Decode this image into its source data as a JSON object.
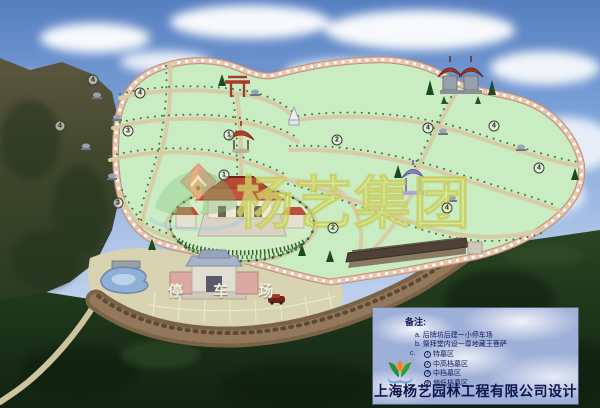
{
  "map": {
    "watermark_text": "杨艺集团",
    "parking_label": "停 车 场"
  },
  "markers": [
    {
      "n": "4",
      "x": 93,
      "y": 80
    },
    {
      "n": "4",
      "x": 140,
      "y": 93
    },
    {
      "n": "4",
      "x": 60,
      "y": 126
    },
    {
      "n": "3",
      "x": 128,
      "y": 131
    },
    {
      "n": "1",
      "x": 229,
      "y": 135
    },
    {
      "n": "2",
      "x": 337,
      "y": 140
    },
    {
      "n": "4",
      "x": 428,
      "y": 128
    },
    {
      "n": "4",
      "x": 494,
      "y": 126
    },
    {
      "n": "4",
      "x": 539,
      "y": 168
    },
    {
      "n": "1",
      "x": 224,
      "y": 175
    },
    {
      "n": "2",
      "x": 333,
      "y": 228
    },
    {
      "n": "4",
      "x": 447,
      "y": 208
    },
    {
      "n": "3",
      "x": 118,
      "y": 203
    }
  ],
  "legend": {
    "title": "备注:",
    "note_a": "a. 后牌坊后建一小停车场",
    "note_b": "b. 祭拜堂内设一尊地藏王菩萨",
    "note_c_prefix": "c.",
    "zones": [
      {
        "n": "1",
        "label": "特墓区"
      },
      {
        "n": "2",
        "label": "中高档墓区"
      },
      {
        "n": "3",
        "label": "中档墓区"
      },
      {
        "n": "4",
        "label": "偏低档墓区"
      }
    ],
    "company": "上海杨艺园林工程有限公司设计"
  },
  "colors": {
    "park_green": "#C9ECC3",
    "path_tan": "#D6CCA6",
    "boundary_wall": "#E0B195",
    "parking_tan": "#D8D4B2",
    "legend_bg": "#A9B6DD",
    "legend_text": "#14195C",
    "watermark_yellow": "#DEE278",
    "sky_blue": "#7FA4DA",
    "forest_dark": "#1C3419"
  }
}
